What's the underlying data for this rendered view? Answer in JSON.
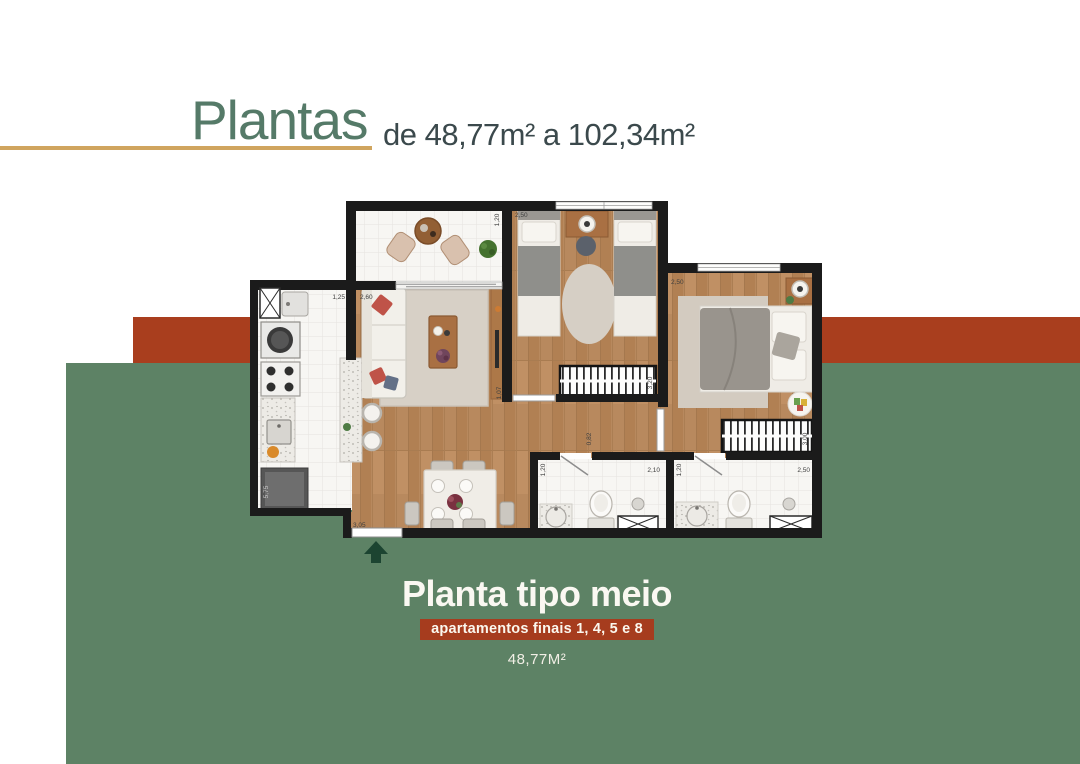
{
  "header": {
    "title": "Plantas",
    "subtitle": "de 48,77m² a 102,34m²"
  },
  "footer": {
    "plan_name": "Planta tipo meio",
    "badge": "apartamentos finais 1, 4, 5 e 8",
    "area": "48,77M²"
  },
  "colors": {
    "green_panel": "#5d8265",
    "rust_stripe": "#a93e1e",
    "badge_bg": "#a63c1e",
    "gold_line": "#d0a55f",
    "title_green": "#557a68",
    "subtitle_dark": "#3b494c",
    "footer_text": "#faf8f2",
    "wall_black": "#1b1b1b",
    "wood_floor": "#b8895e",
    "entry_arrow_green": "#1c4431"
  },
  "plan": {
    "dims": {
      "kitchen_w": "1,25",
      "living_w": "2,60",
      "balcony_d": "1,20",
      "bed1_w": "2,50",
      "bed2_w": "2,50",
      "bed1_len": "3,20",
      "rack": "1,07",
      "hall": "0,82",
      "bath1_w": "1,20",
      "bath1_len": "2,10",
      "bath2_w": "1,20",
      "bath2_len": "2,50",
      "wardrobe2_len": "3,00",
      "kitchen_len": "5,75",
      "entry_w": "3,05"
    }
  }
}
